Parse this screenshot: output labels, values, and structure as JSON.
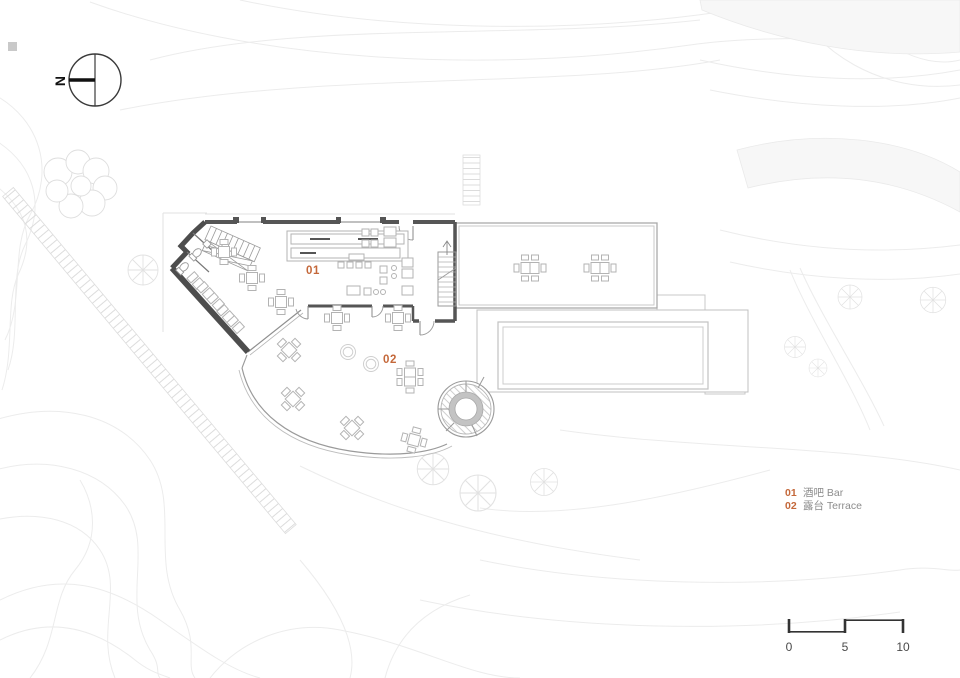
{
  "north": {
    "label": "N"
  },
  "rooms": {
    "bar": {
      "num": "01"
    },
    "terrace": {
      "num": "02"
    }
  },
  "legend": {
    "items": [
      {
        "num": "01",
        "label": "酒吧 Bar"
      },
      {
        "num": "02",
        "label": "露台 Terrace"
      }
    ]
  },
  "scale": {
    "labels": [
      "0",
      "5",
      "10"
    ]
  },
  "colors": {
    "accent": "#C4683A",
    "wall": "#4F4F4F",
    "legend_text": "#8C8C8C",
    "scale_text": "#4a4a4a",
    "contour": "#ececec",
    "furniture": "#b3b3b3"
  }
}
